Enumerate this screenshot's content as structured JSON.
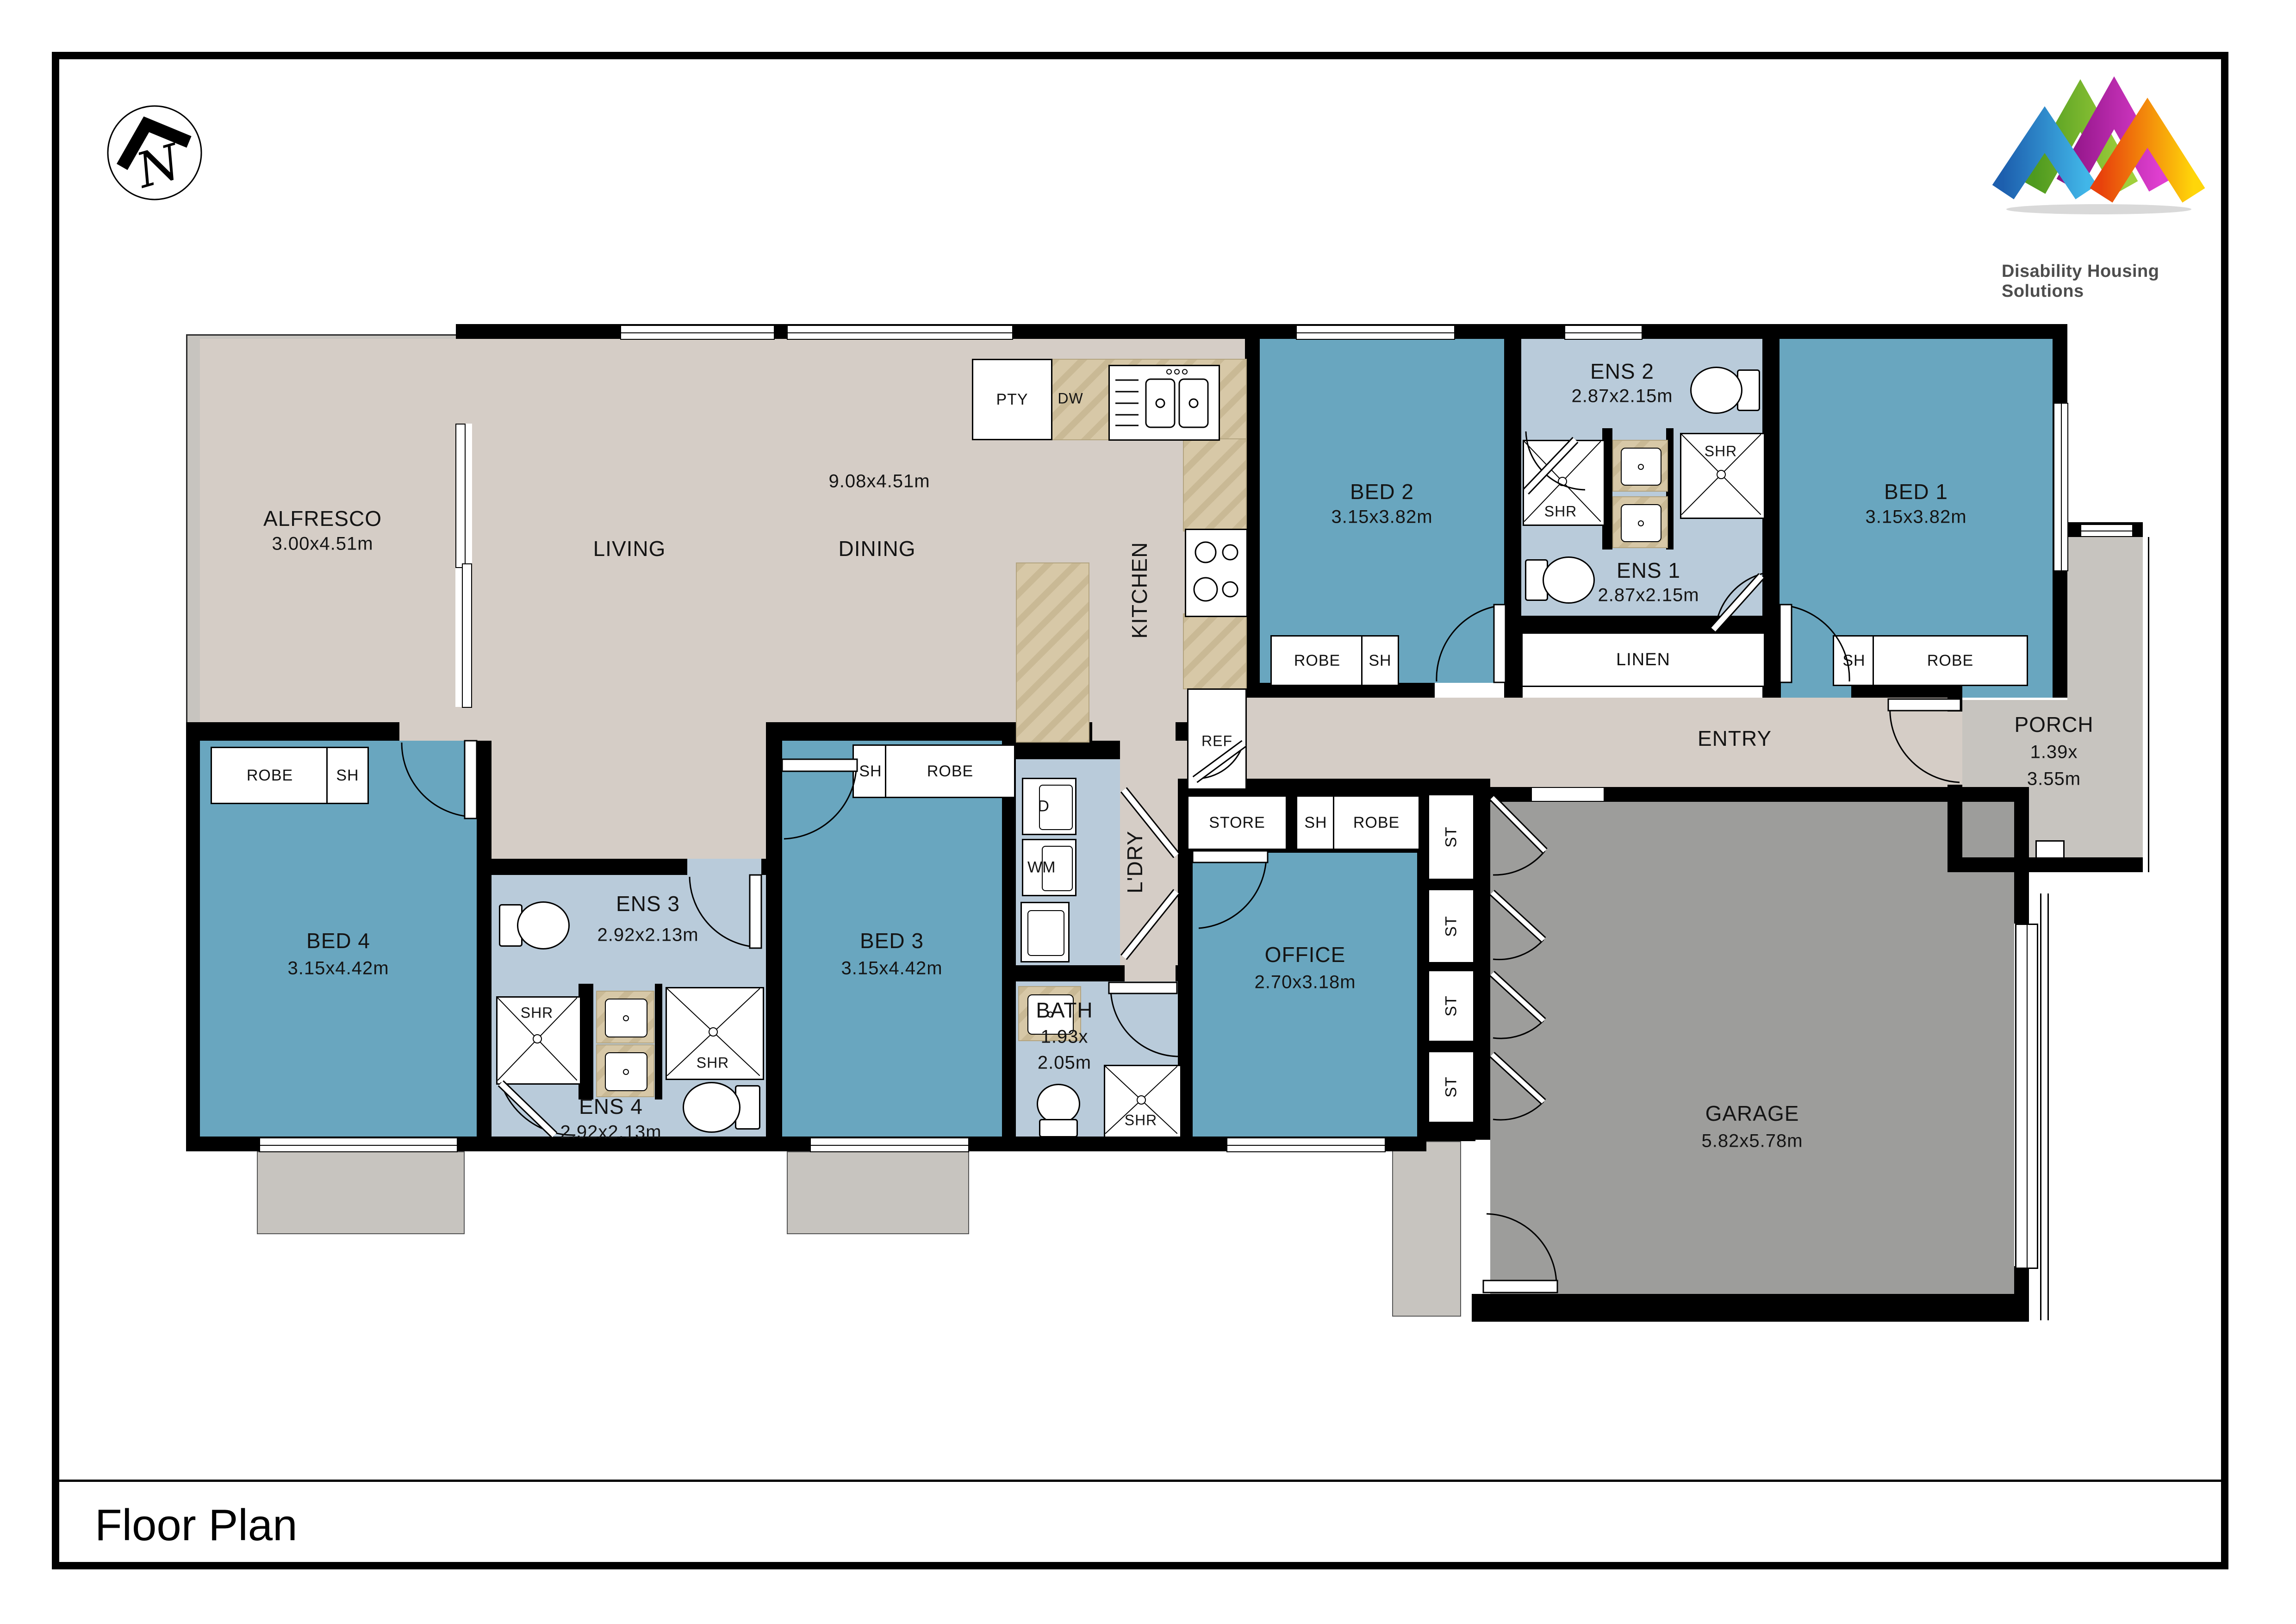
{
  "page": {
    "title": "Floor Plan"
  },
  "logo": {
    "company": "Disability Housing Solutions"
  },
  "compass": {
    "letter": "N"
  },
  "colors": {
    "bedroom_teal": "#69a6bf",
    "ensuite_blue": "#b9cbda",
    "hall_beige": "#d5cdc6",
    "outdoor_gray": "#c7c4bf",
    "garage_gray": "#9d9d9b",
    "bench_marble": "#d7c8a7",
    "wall_black": "#000000"
  },
  "rooms": {
    "alfresco": {
      "label": "ALFRESCO",
      "dims": "3.00x4.51m"
    },
    "living": {
      "label": "LIVING"
    },
    "dining": {
      "label": "DINING"
    },
    "living_dining": {
      "dims": "9.08x4.51m"
    },
    "kitchen": {
      "label": "KITCHEN"
    },
    "bed1": {
      "label": "BED 1",
      "dims": "3.15x3.82m"
    },
    "bed2": {
      "label": "BED 2",
      "dims": "3.15x3.82m"
    },
    "bed3": {
      "label": "BED 3",
      "dims": "3.15x4.42m"
    },
    "bed4": {
      "label": "BED 4",
      "dims": "3.15x4.42m"
    },
    "ens1": {
      "label": "ENS 1",
      "dims": "2.87x2.15m"
    },
    "ens2": {
      "label": "ENS 2",
      "dims": "2.87x2.15m"
    },
    "ens3": {
      "label": "ENS 3",
      "dims": "2.92x2.13m"
    },
    "ens4": {
      "label": "ENS 4",
      "dims": "2.92x2.13m"
    },
    "bath": {
      "label": "BATH",
      "dims_line1": "1.93x",
      "dims_line2": "2.05m"
    },
    "office": {
      "label": "OFFICE",
      "dims": "2.70x3.18m"
    },
    "garage": {
      "label": "GARAGE",
      "dims": "5.82x5.78m"
    },
    "porch": {
      "label": "PORCH",
      "dims_line1": "1.39x",
      "dims_line2": "3.55m"
    },
    "entry": {
      "label": "ENTRY"
    },
    "ldry": {
      "label": "L'DRY"
    },
    "linen": {
      "label": "LINEN"
    },
    "store": {
      "label": "STORE"
    }
  },
  "fixtures": {
    "pty": "PTY",
    "dw": "DW",
    "ref": "REF",
    "d": "D",
    "wm": "WM",
    "shr": "SHR",
    "st": "ST",
    "robe": "ROBE",
    "sh": "SH"
  }
}
